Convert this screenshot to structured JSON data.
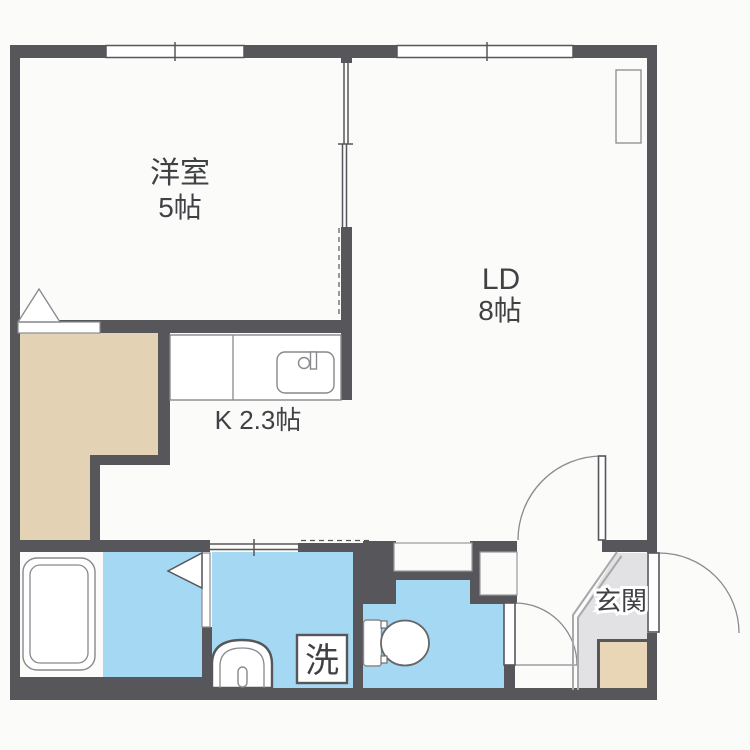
{
  "floorplan": {
    "title": "1LDK apartment floor plan",
    "rooms": {
      "western_room": {
        "name": "洋室",
        "size": "5帖"
      },
      "living_dining": {
        "name": "LD",
        "size": "8帖"
      },
      "kitchen": {
        "label": "K 2.3帖"
      },
      "entrance": {
        "label": "玄関"
      },
      "washer": {
        "label": "洗"
      }
    },
    "colors": {
      "background": "#fbfbf9",
      "wall": "#57575b",
      "water_area": "#a5d8f2",
      "closet_floor": "#e4d2b5",
      "entrance_floor": "#e2e1e3",
      "shoe_storage": "#e8d6b7",
      "text": "#404145"
    }
  }
}
